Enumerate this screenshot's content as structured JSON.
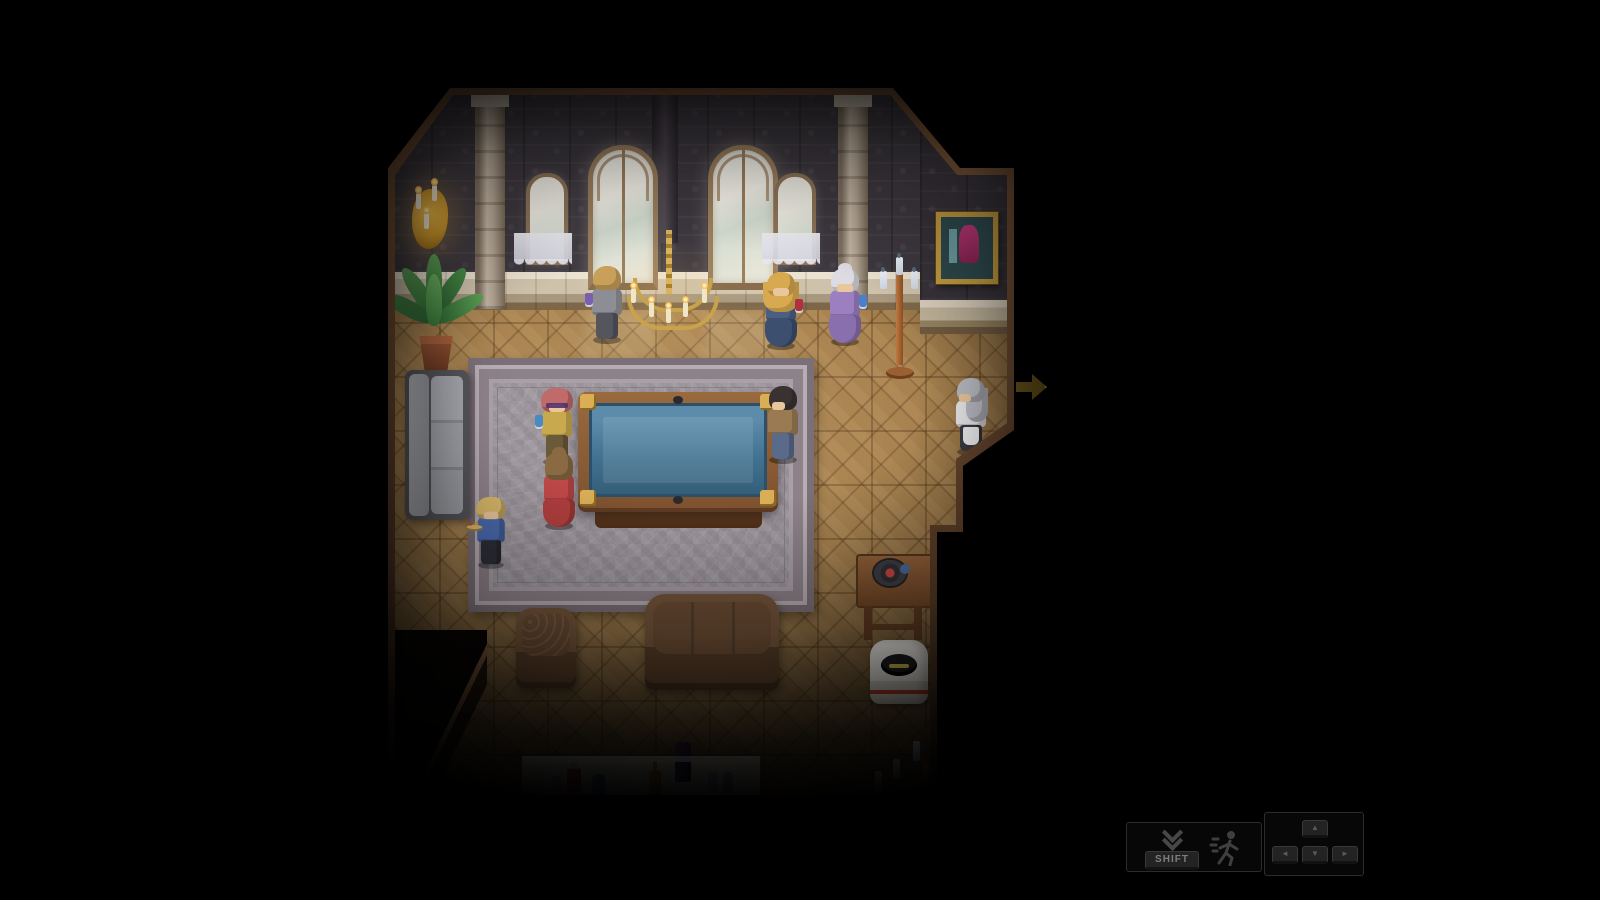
{
  "game": {
    "scene_label": "mansion-billiards-parlor",
    "palette": {
      "background": "#000000",
      "wallpaper": "#3e3940",
      "wainscot": "#d8cdbb",
      "floor_parquet": "#a8824f",
      "wall_trim": "#6b4a33",
      "rug": "#a19ba1",
      "billiard_felt": "#41718f",
      "billiard_wood": "#8a5a36",
      "gold_accent": "#c9a34c",
      "exit_arrow": "#8a7020"
    },
    "npcs": [
      {
        "id": "gray-suit-man",
        "label": "blonde man in gray suit holding a purple drink, facing the wall",
        "hair": "#c9a05a",
        "top": "#8d8d95",
        "bottom": "#55555e",
        "drink": "#7a5fae"
      },
      {
        "id": "blonde-woman",
        "label": "long-haired blonde woman in dark blue gown with a red drink",
        "hair": "#d8a94e",
        "top": "#4a5f82",
        "bottom": "#3c4f6e",
        "drink": "#b03040"
      },
      {
        "id": "elderly-woman",
        "label": "white-haired woman in lavender dress with a blue drink",
        "hair": "#dcdce2",
        "top": "#9b7fc0",
        "bottom": "#8a6fae",
        "drink": "#4a7fd0"
      },
      {
        "id": "maid",
        "label": "silver-haired maid standing near the exit",
        "hair": "#b9b9c2",
        "top": "#e8e8ea",
        "bottom": "#3a3a40"
      },
      {
        "id": "dandy",
        "label": "man with rose curls and glasses in mustard jacket holding a blue goblet",
        "hair": "#c06a6a",
        "top": "#c8a94e",
        "bottom": "#6a5a3a",
        "drink": "#4a8ac0"
      },
      {
        "id": "red-dress-woman",
        "label": "woman in red gown watching the billiard table",
        "hair": "#8a6a42",
        "top": "#c04848",
        "bottom": "#b03e3e"
      },
      {
        "id": "young-server",
        "label": "curly-haired young server in blue coat carrying a tray",
        "hair": "#d8b86a",
        "top": "#4a6ab0",
        "bottom": "#2e2e38"
      },
      {
        "id": "brown-jacket-man",
        "label": "dark-haired man in tan jacket and jeans beside the table",
        "hair": "#3a3230",
        "top": "#9a7a52",
        "bottom": "#5a6a8a"
      }
    ],
    "furniture": [
      {
        "id": "wall-sconce",
        "label": "gilded wall sconce with lit candles"
      },
      {
        "id": "potted-plant",
        "label": "potted palm plant"
      },
      {
        "id": "gray-couch",
        "label": "gray couch along the left wall"
      },
      {
        "id": "arched-windows",
        "label": "two tall arched windows and two lace-curtained windows"
      },
      {
        "id": "chandelier",
        "label": "gold candle chandelier"
      },
      {
        "id": "framed-painting",
        "label": "gold-framed painting in alcove"
      },
      {
        "id": "standing-candelabra",
        "label": "copper standing candelabra"
      },
      {
        "id": "billiard-table",
        "label": "billiard table with blue felt"
      },
      {
        "id": "ornate-rug",
        "label": "large ornate gray rug"
      },
      {
        "id": "armchair",
        "label": "upholstered armchair"
      },
      {
        "id": "sofa",
        "label": "upholstered sofa"
      },
      {
        "id": "refreshment-table",
        "label": "white refreshment table with bottles and glasses"
      },
      {
        "id": "gramophone",
        "label": "gramophone on wooden side table"
      },
      {
        "id": "ice-bucket",
        "label": "white ice bucket"
      },
      {
        "id": "floor-candelabra",
        "label": "floor candelabra with pale candles"
      }
    ],
    "exit": {
      "direction": "right",
      "icon": "exit-arrow-icon"
    },
    "hud": {
      "dash_hint": {
        "key_label": "SHIFT",
        "icons": [
          "double-down-chevron-icon",
          "runner-icon"
        ]
      },
      "move_hint": {
        "keys": [
          {
            "id": "up",
            "glyph": "▲"
          },
          {
            "id": "left",
            "glyph": "◄"
          },
          {
            "id": "down",
            "glyph": "▼"
          },
          {
            "id": "right",
            "glyph": "►"
          }
        ]
      }
    }
  }
}
